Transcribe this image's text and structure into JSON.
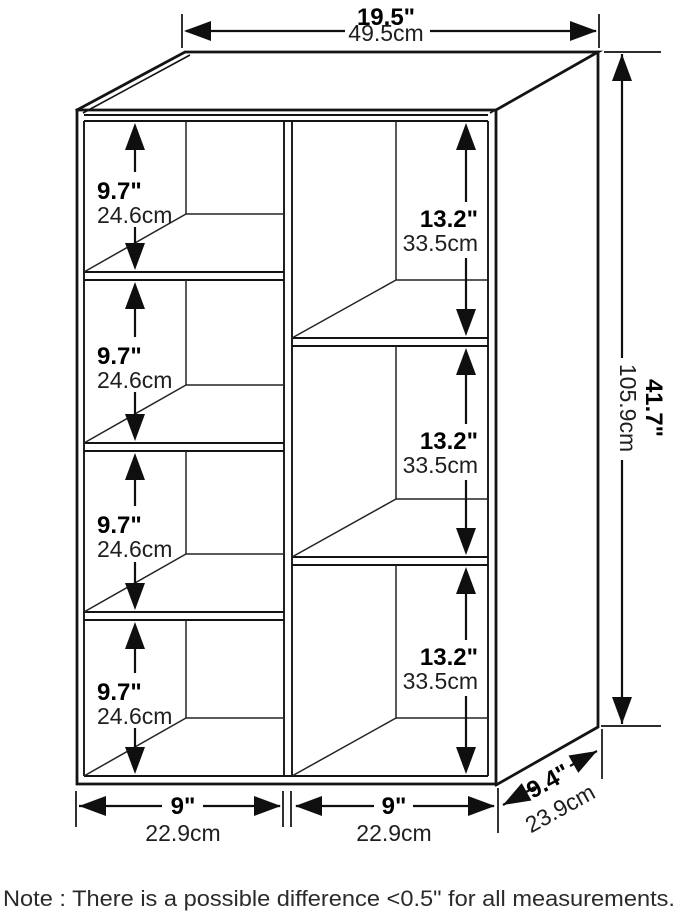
{
  "dimensions": {
    "width": {
      "in": "19.5\"",
      "cm": "49.5cm"
    },
    "height": {
      "in": "41.7\"",
      "cm": "105.9cm"
    },
    "depth": {
      "in": "9.4\"",
      "cm": "23.9cm"
    },
    "left_cells": [
      {
        "in": "9.7\"",
        "cm": "24.6cm"
      },
      {
        "in": "9.7\"",
        "cm": "24.6cm"
      },
      {
        "in": "9.7\"",
        "cm": "24.6cm"
      },
      {
        "in": "9.7\"",
        "cm": "24.6cm"
      }
    ],
    "right_cells": [
      {
        "in": "13.2\"",
        "cm": "33.5cm"
      },
      {
        "in": "13.2\"",
        "cm": "33.5cm"
      },
      {
        "in": "13.2\"",
        "cm": "33.5cm"
      }
    ],
    "bottom_spans": [
      {
        "in": "9\"",
        "cm": "22.9cm"
      },
      {
        "in": "9\"",
        "cm": "22.9cm"
      }
    ]
  },
  "note": "Note : There is a possible difference <0.5\" for all measurements.",
  "colors": {
    "line": "#141414",
    "text": "#000000",
    "background": "#ffffff"
  }
}
